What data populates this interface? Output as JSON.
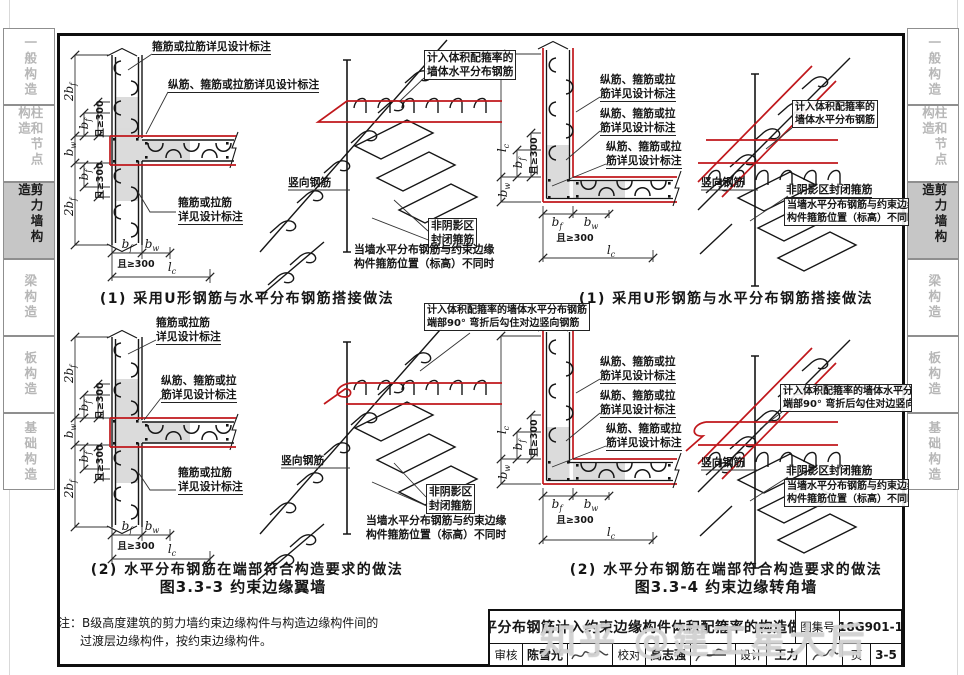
{
  "page": {
    "watermark": "知乎 @建工星大后"
  },
  "sidebar": {
    "tabs": [
      {
        "label": "一般构造"
      },
      {
        "label": "柱和节点构造"
      },
      {
        "label": "剪力墙构造"
      },
      {
        "label": "梁构造"
      },
      {
        "label": "板构造"
      },
      {
        "label": "基础构造"
      }
    ],
    "active_index": 2
  },
  "labels": {
    "stirrup_tie_full": "箍筋或拉筋详见设计标注",
    "stirrup_tie_1": "箍筋或拉筋",
    "stirrup_tie_2": "详见设计标注",
    "long_full": "纵筋、箍筋或拉筋详见设计标注",
    "long_1": "纵筋、箍筋或拉",
    "long_2": "筋详见设计标注",
    "calc_1": "计入体积配箍率的",
    "calc_2": "墙体水平分布钢筋",
    "calc_full": "计入体积配箍率的墙体水平分布钢筋",
    "hook90": "端部90° 弯折后勾住对边竖向钢筋",
    "vertical_rebar": "竖向钢筋",
    "nonshade_1": "非阴影区",
    "nonshade_2": "封闭箍筋",
    "nonshade_full": "非阴影区封闭箍筋",
    "diff_1": "当墙水平分布钢筋与约束边缘",
    "diff_2": "构件箍筋位置（标高）不同时"
  },
  "dims": {
    "two_bf": "2b_f",
    "bf": "b_f",
    "bw": "b_w",
    "lc": "l_c",
    "ge300": "且≥300"
  },
  "captions": {
    "method1": "(1) 采用U形钢筋与水平分布钢筋搭接做法",
    "method2": "(2) 水平分布钢筋在端部符合构造要求的做法"
  },
  "figures": {
    "fig33_3": "图3.3-3 约束边缘翼墙",
    "fig33_4": "图3.3-4 约束边缘转角墙"
  },
  "note": {
    "line1": "注：B级高度建筑的剪力墙约束边缘构件与构造边缘构件间的",
    "line2": "过渡层边缘构件，按约束边缘构件。"
  },
  "titleblock": {
    "title": "水平分布钢筋计入约束边缘构件体积配箍率的构造做法",
    "atlas_label": "图集号",
    "atlas_no": "18G901-1",
    "review_label": "审核",
    "reviewer": "陈雪光",
    "check_label": "校对",
    "checker": "高志强",
    "design_label": "设计",
    "designer": "王力",
    "page_label": "页",
    "page_no": "3-5"
  },
  "colors": {
    "red": "#c0181c",
    "shade": "#b9b9b9",
    "active_tab_bg": "#c6c6c6"
  }
}
